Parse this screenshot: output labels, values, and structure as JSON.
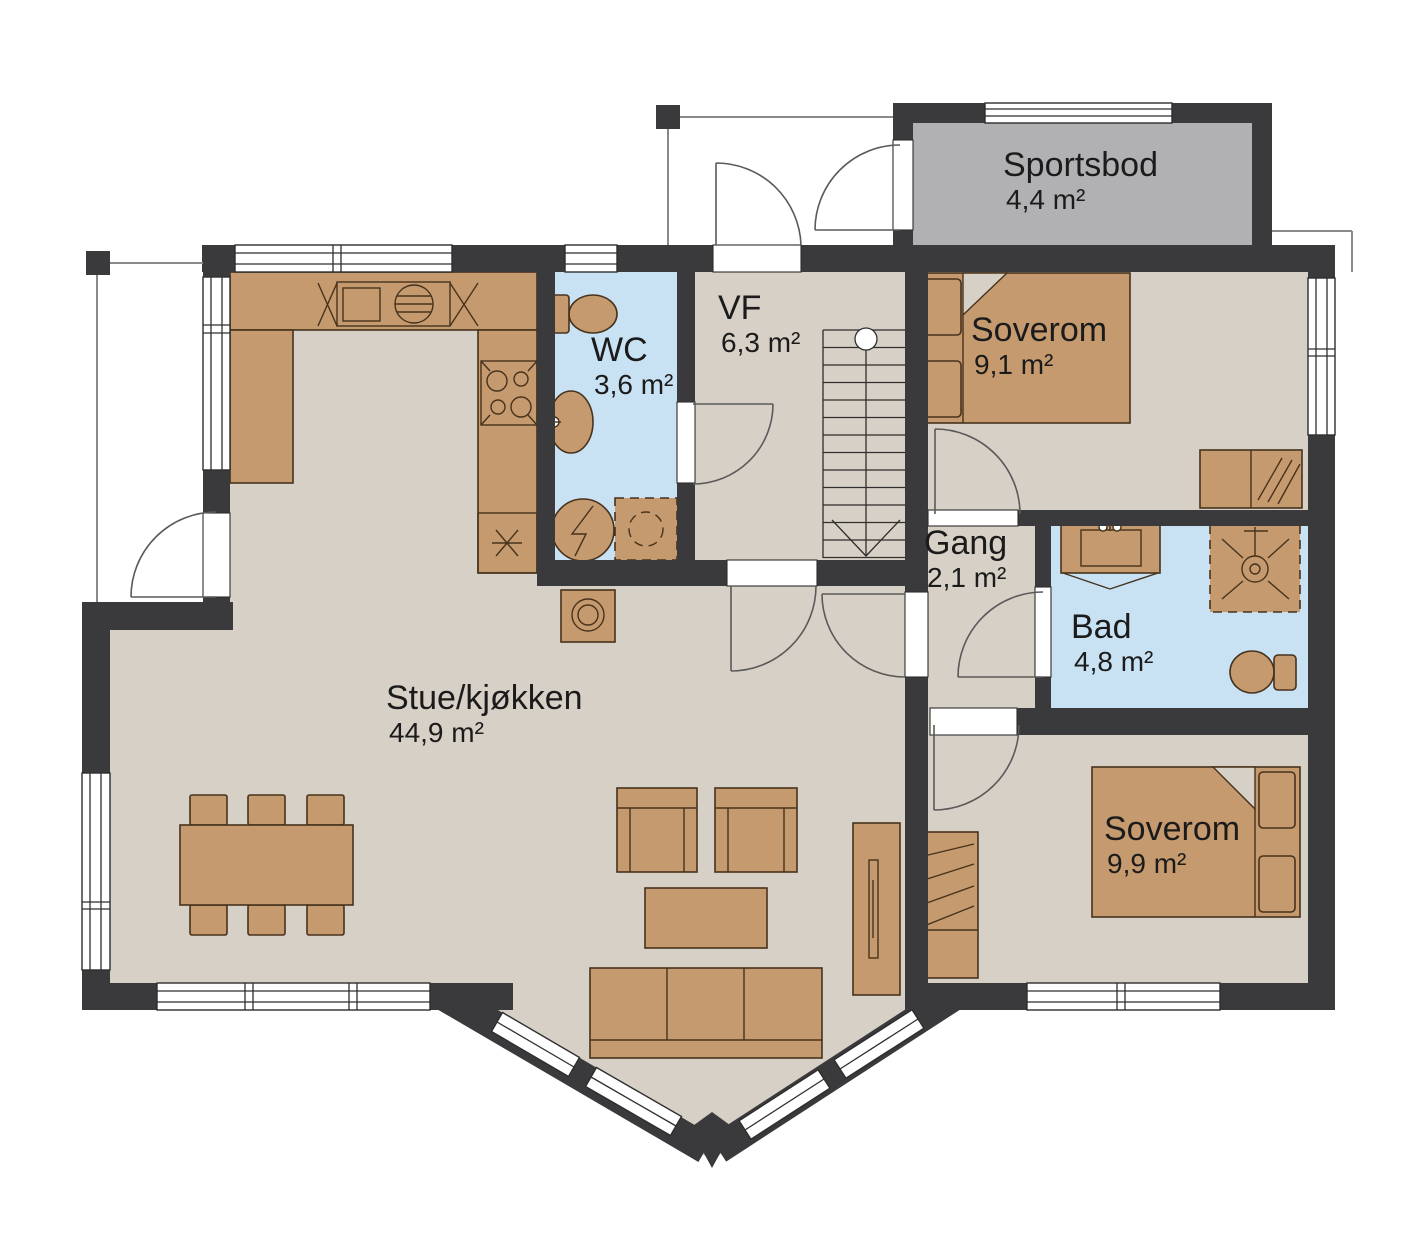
{
  "plan": {
    "type": "floor-plan",
    "rooms": {
      "sportsbod": {
        "name": "Sportsbod",
        "area": "4,4 m²"
      },
      "wc": {
        "name": "WC",
        "area": "3,6 m²"
      },
      "vf": {
        "name": "VF",
        "area": "6,3 m²"
      },
      "soverom_1": {
        "name": "Soverom",
        "area": "9,1 m²"
      },
      "gang": {
        "name": "Gang",
        "area": "2,1 m²"
      },
      "bad": {
        "name": "Bad",
        "area": "4,8 m²"
      },
      "stue_kjokken": {
        "name": "Stue/kjøkken",
        "area": "44,9 m²"
      },
      "soverom_2": {
        "name": "Soverom",
        "area": "9,9 m²"
      }
    },
    "colors": {
      "background": "#ffffff",
      "wall": "#3a3a3c",
      "floor": "#d7d0c6",
      "wet_room": "#c9e2f3",
      "storage": "#b1b1b3",
      "furniture": "#c59a6e",
      "furniture_outline": "#46321c"
    }
  }
}
